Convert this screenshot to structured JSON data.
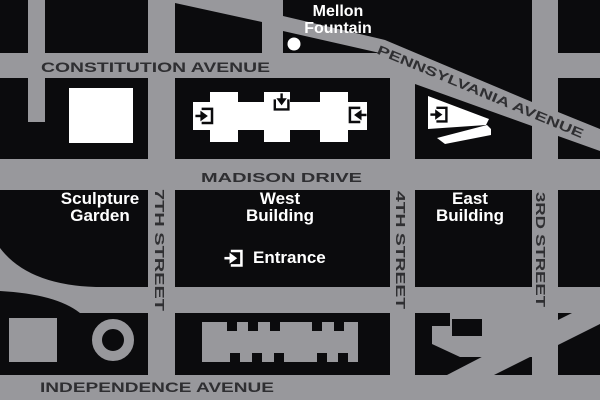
{
  "colors": {
    "road_gray": "#98989C",
    "block_black": "#0B0B0D",
    "street_text": "#2F2F32",
    "label_white": "#FFFFFF"
  },
  "map": {
    "streets": {
      "constitution": "CONSTITUTION AVENUE",
      "pennsylvania": "PENNSYLVANIA AVENUE",
      "madison": "MADISON DRIVE",
      "independence": "INDEPENDENCE AVENUE",
      "seventh": "7TH STREET",
      "fourth": "4TH STREET",
      "third": "3RD STREET"
    },
    "places": {
      "sculpture_line1": "Sculpture",
      "sculpture_line2": "Garden",
      "west_line1": "West",
      "west_line2": "Building",
      "east_line1": "East",
      "east_line2": "Building"
    },
    "markers": {
      "mellon_line1": "Mellon",
      "mellon_line2": "Fountain"
    },
    "legend": {
      "entrance_label": "Entrance"
    }
  }
}
